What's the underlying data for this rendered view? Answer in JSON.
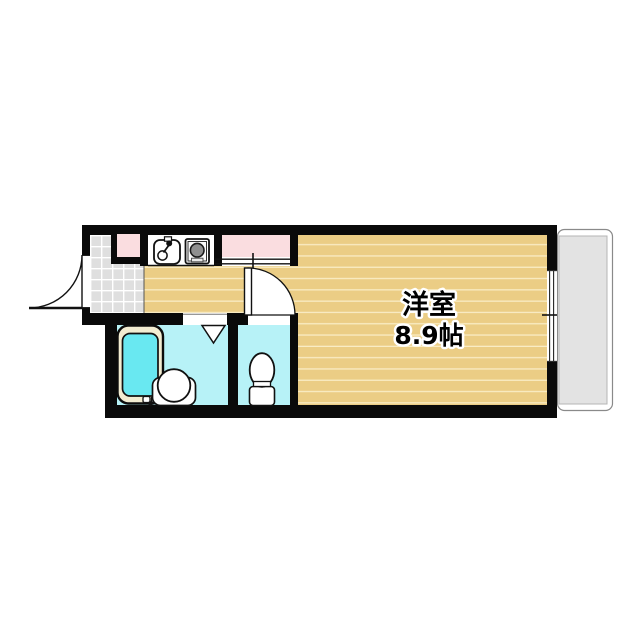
{
  "plan": {
    "type": "apartment-floor-plan",
    "rooms": {
      "main_room": {
        "label": "洋室",
        "size": "8.9帖"
      }
    },
    "fixtures": [
      "entrance-swing-door",
      "genkan-tile-floor",
      "shoe-cabinet",
      "kitchen-sink-icon",
      "stove-burner-icon",
      "closet-sliding-doors",
      "bathtub",
      "washbasin",
      "folding-door-mark",
      "toilet",
      "toilet-swing-door",
      "sliding-window",
      "balcony"
    ],
    "colors": {
      "wall": "#0a0a0a",
      "wood_floor": "#ebcd85",
      "wood_plank_line": "#f9ecc4",
      "wet_area_floor": "#b7f2f7",
      "bath_water": "#69e8f1",
      "tub_rim": "#f3edd2",
      "closet_pink": "#fadde0",
      "tile_gray": "#dfdfdf",
      "balcony_gray": "#e3e3e3"
    }
  }
}
